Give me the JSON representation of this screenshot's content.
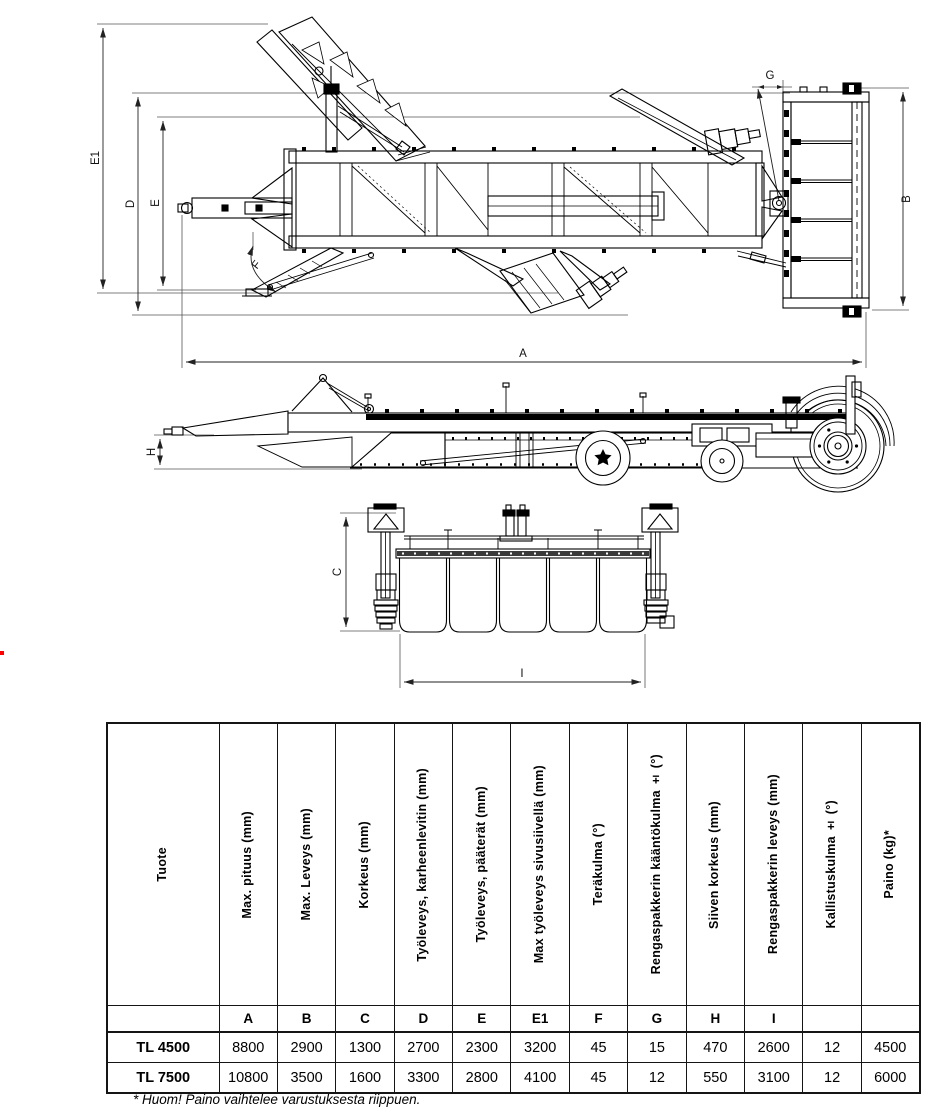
{
  "drawing": {
    "labels": {
      "e1": "E1",
      "d": "D",
      "e": "E",
      "f": "F",
      "a": "A",
      "g": "G",
      "b": "B",
      "h": "H",
      "c": "C",
      "i": "I"
    }
  },
  "table": {
    "product_header": "Tuote",
    "columns": [
      {
        "label": "Max. pituus (mm)"
      },
      {
        "label": "Max. Leveys (mm)"
      },
      {
        "label": "Korkeus (mm)"
      },
      {
        "label": "Työleveys, karheenlevitin (mm)"
      },
      {
        "label": "Työleveys, pääterät (mm)"
      },
      {
        "label": "Max työleveys sivusiivellä (mm)"
      },
      {
        "label": "Teräkulma (°)"
      },
      {
        "label": "Rengaspakkerin kääntökulma ± (°)"
      },
      {
        "label": "Siiven korkeus (mm)"
      },
      {
        "label": "Rengaspakkerin leveys (mm)"
      },
      {
        "label": "Kallistuskulma ± (°)"
      },
      {
        "label": "Paino (kg)*"
      }
    ],
    "letters": [
      "A",
      "B",
      "C",
      "D",
      "E",
      "E1",
      "F",
      "G",
      "H",
      "I",
      "",
      ""
    ],
    "rows": [
      {
        "product": "TL 4500",
        "values": [
          "8800",
          "2900",
          "1300",
          "2700",
          "2300",
          "3200",
          "45",
          "15",
          "470",
          "2600",
          "12",
          "4500"
        ]
      },
      {
        "product": "TL 7500",
        "values": [
          "10800",
          "3500",
          "1600",
          "3300",
          "2800",
          "4100",
          "45",
          "12",
          "550",
          "3100",
          "12",
          "6000"
        ]
      }
    ],
    "footnote": "* Huom! Paino vaihtelee varustuksesta riippuen."
  }
}
